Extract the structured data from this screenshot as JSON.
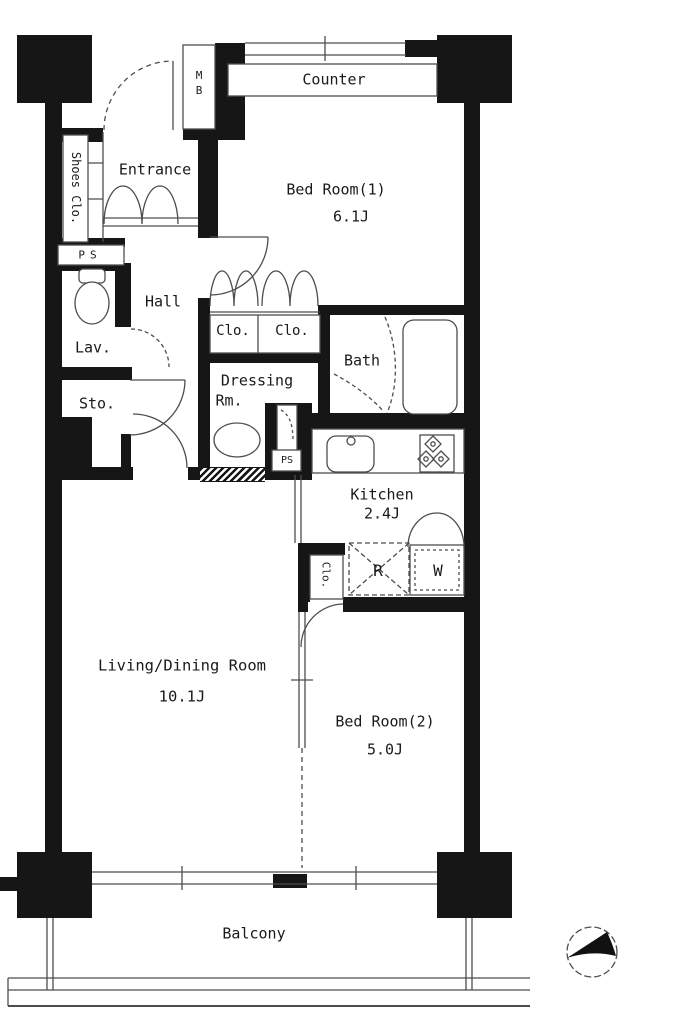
{
  "colors": {
    "wall": "#161616",
    "line": "#4d4d4d",
    "text": "#1a1a1a",
    "bg": "#ffffff"
  },
  "labels": {
    "counter": "Counter",
    "mb": "MB",
    "shoes_closet": "Shoes Clo.",
    "ps_upper": "PS",
    "entrance": "Entrance",
    "bedroom1_name": "Bed Room(1)",
    "bedroom1_size": "6.1J",
    "hall": "Hall",
    "lavatory": "Lav.",
    "storage": "Sto.",
    "closet_a": "Clo.",
    "closet_b": "Clo.",
    "bath": "Bath",
    "dressing_line1": "Dressing",
    "dressing_line2": "Rm.",
    "ps_lower": "PS",
    "kitchen_name": "Kitchen",
    "kitchen_size": "2.4J",
    "closet_kitchen": "Clo.",
    "refrigerator": "R",
    "washer": "W",
    "living_name": "Living/Dining Room",
    "living_size": "10.1J",
    "bedroom2_name": "Bed Room(2)",
    "bedroom2_size": "5.0J",
    "balcony": "Balcony"
  }
}
